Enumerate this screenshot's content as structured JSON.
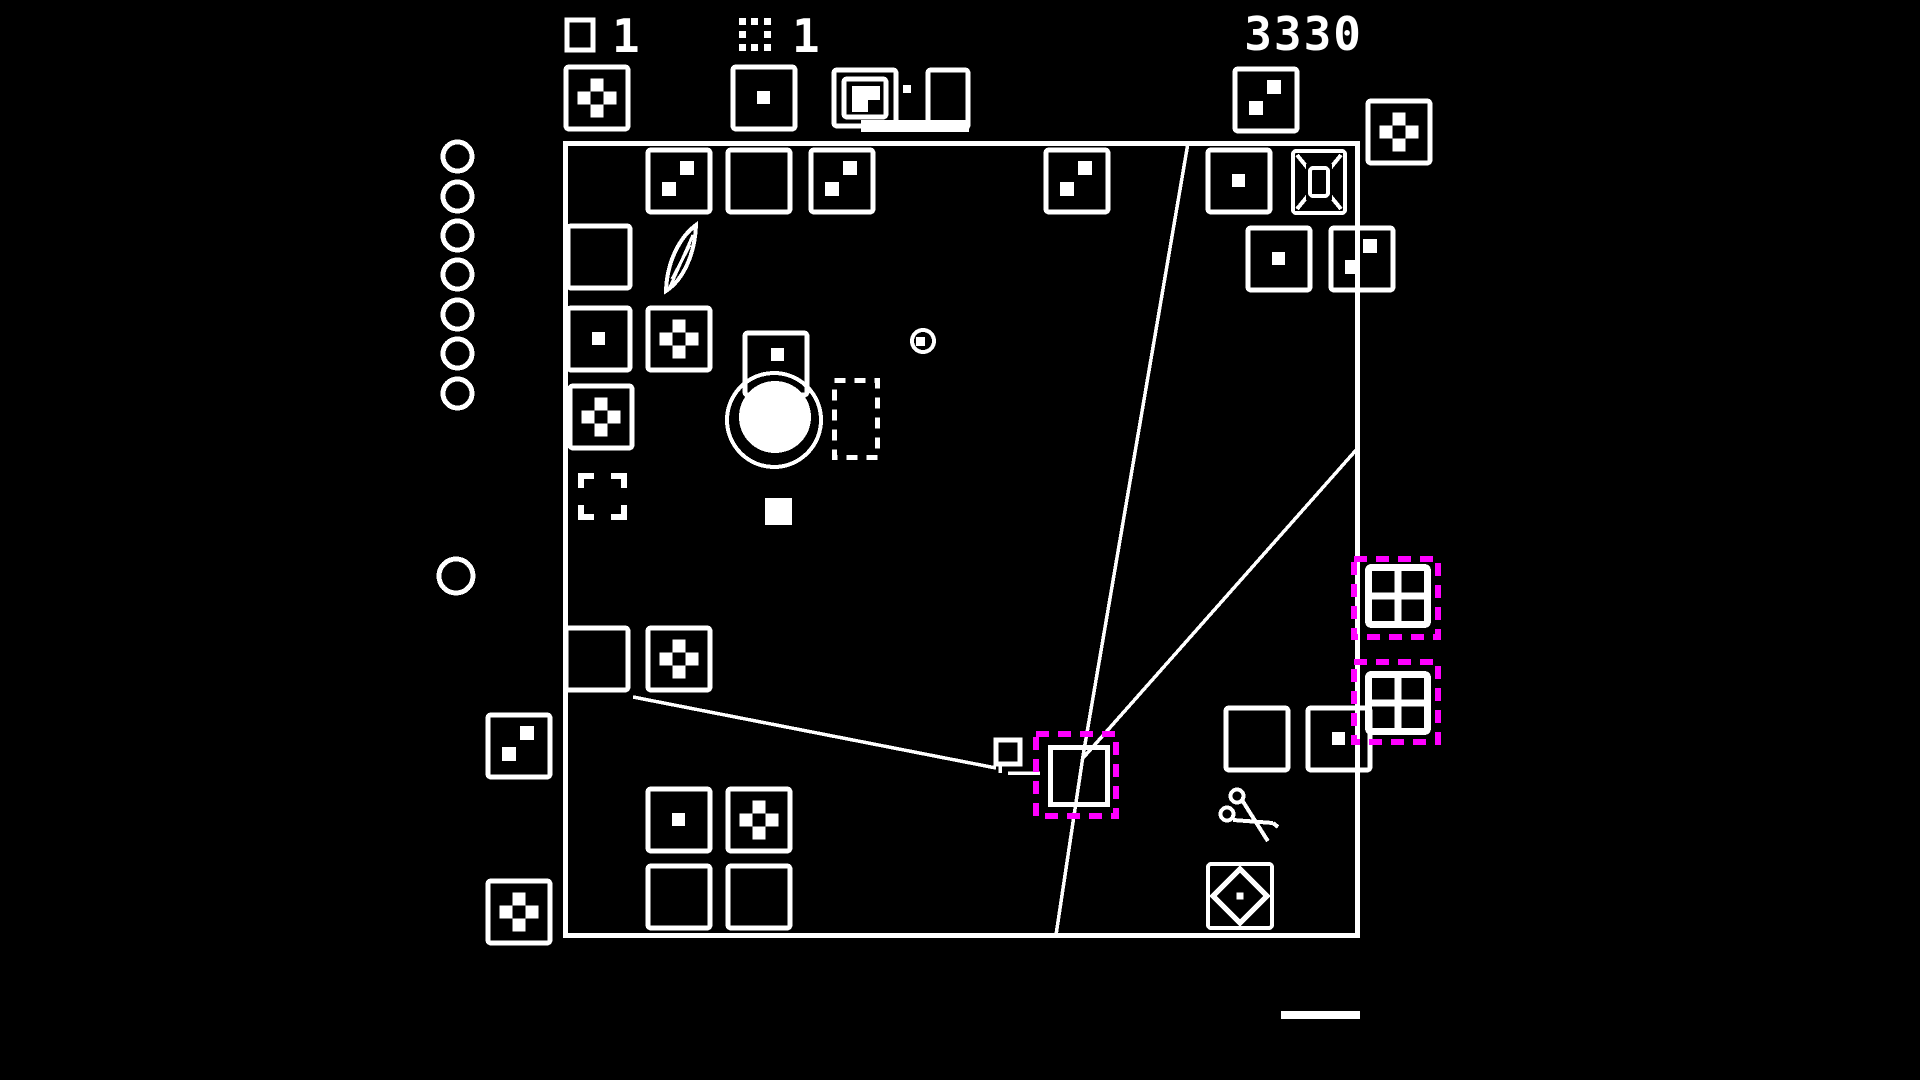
{
  "colors": {
    "background": "#000000",
    "foreground": "#ffffff",
    "highlight": "#ff00ff"
  },
  "hud": {
    "square_count": "1",
    "grid_count": "1",
    "score": "3330",
    "square_icon": "square-outline-icon",
    "grid_icon": "dotted-square-icon"
  },
  "board": {
    "x": 563,
    "y": 141,
    "width": 797,
    "height": 797
  },
  "tiles": [
    {
      "glyph": "dice4",
      "x": 563,
      "y": 64
    },
    {
      "glyph": "dice1",
      "x": 730,
      "y": 64
    },
    {
      "glyph": "stack",
      "x": 831,
      "y": 60,
      "w": 145,
      "h": 80
    },
    {
      "glyph": "dice2",
      "x": 1232,
      "y": 66
    },
    {
      "glyph": "dice4",
      "x": 1365,
      "y": 98
    },
    {
      "glyph": "dice2",
      "x": 645,
      "y": 147
    },
    {
      "glyph": "plain",
      "x": 725,
      "y": 147
    },
    {
      "glyph": "dice2",
      "x": 808,
      "y": 147
    },
    {
      "glyph": "dice2",
      "x": 1043,
      "y": 147
    },
    {
      "glyph": "dice1",
      "x": 1205,
      "y": 147
    },
    {
      "glyph": "portal",
      "x": 1290,
      "y": 148,
      "w": 58,
      "h": 68
    },
    {
      "glyph": "dice1",
      "x": 1245,
      "y": 225
    },
    {
      "glyph": "dice2",
      "x": 1328,
      "y": 225
    },
    {
      "glyph": "plain",
      "x": 565,
      "y": 223
    },
    {
      "glyph": "leaf",
      "x": 660,
      "y": 221,
      "w": 42,
      "h": 75
    },
    {
      "glyph": "dice1",
      "x": 565,
      "y": 305
    },
    {
      "glyph": "dice4",
      "x": 645,
      "y": 305
    },
    {
      "glyph": "dice4",
      "x": 567,
      "y": 383
    },
    {
      "glyph": "bracket",
      "x": 578,
      "y": 473,
      "w": 49,
      "h": 47
    },
    {
      "glyph": "dice1t",
      "x": 742,
      "y": 330
    },
    {
      "glyph": "plain",
      "x": 563,
      "y": 625
    },
    {
      "glyph": "dice4",
      "x": 645,
      "y": 625
    },
    {
      "glyph": "dice2",
      "x": 485,
      "y": 712
    },
    {
      "glyph": "dice4",
      "x": 485,
      "y": 878
    },
    {
      "glyph": "dice1",
      "x": 645,
      "y": 786
    },
    {
      "glyph": "dice4",
      "x": 725,
      "y": 786
    },
    {
      "glyph": "plain",
      "x": 645,
      "y": 863
    },
    {
      "glyph": "plain",
      "x": 725,
      "y": 863
    },
    {
      "glyph": "plain",
      "x": 1223,
      "y": 705
    },
    {
      "glyph": "dice1",
      "x": 1305,
      "y": 705
    },
    {
      "glyph": "scissors",
      "x": 1218,
      "y": 783,
      "w": 62,
      "h": 64
    },
    {
      "glyph": "diamond",
      "x": 1206,
      "y": 862
    },
    {
      "glyph": "window",
      "x": 1365,
      "y": 564,
      "w": 66,
      "h": 64
    },
    {
      "glyph": "window",
      "x": 1365,
      "y": 671,
      "w": 66,
      "h": 64
    }
  ],
  "zones": [
    {
      "type": "ghost",
      "x": 832,
      "y": 378,
      "w": 48,
      "h": 82
    },
    {
      "type": "outline",
      "x": 1048,
      "y": 745,
      "w": 62,
      "h": 62
    },
    {
      "type": "target",
      "x": 1033,
      "y": 731,
      "w": 86,
      "h": 88
    },
    {
      "type": "target",
      "x": 1351,
      "y": 556,
      "w": 90,
      "h": 84
    },
    {
      "type": "target",
      "x": 1351,
      "y": 659,
      "w": 90,
      "h": 86
    }
  ],
  "decor": {
    "circle_column": {
      "x": 441,
      "d": 33,
      "tops": [
        140,
        180,
        219,
        258,
        298,
        337,
        377
      ]
    },
    "lone_circle": {
      "x": 437,
      "y": 557,
      "d": 38
    },
    "big_circle": {
      "fill": {
        "cx": 775,
        "cy": 417,
        "r": 36
      },
      "ring": {
        "cx": 774,
        "cy": 420,
        "r": 47
      }
    },
    "mini_circle": {
      "cx": 923,
      "cy": 341,
      "r": 11,
      "dot": {
        "x": 916,
        "y": 337,
        "s": 9
      }
    },
    "small_filled_square": {
      "x": 765,
      "y": 498,
      "s": 27
    },
    "small_square_outline": {
      "x": 996,
      "y": 740,
      "s": 24
    },
    "underline": {
      "x": 1281,
      "y": 1011,
      "w": 79,
      "h": 8
    }
  },
  "lines": [
    [
      [
        1188,
        143
      ],
      [
        1083,
        756
      ],
      [
        1056,
        935
      ]
    ],
    [
      [
        1083,
        758
      ],
      [
        1357,
        449
      ]
    ],
    [
      [
        633,
        697
      ],
      [
        996,
        768
      ]
    ],
    [
      [
        1008,
        773
      ],
      [
        1040,
        773
      ]
    ],
    [
      [
        1000,
        762
      ],
      [
        1000,
        773
      ]
    ]
  ]
}
